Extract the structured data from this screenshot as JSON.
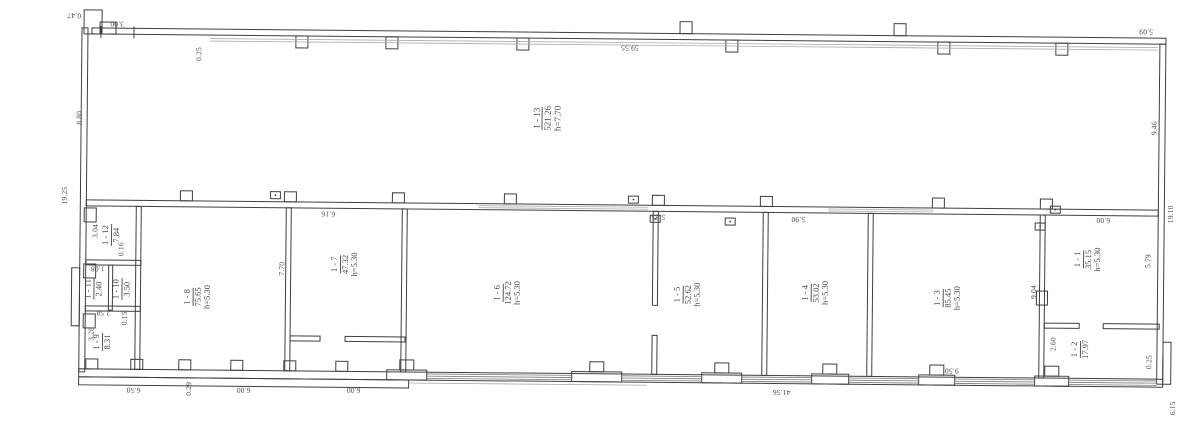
{
  "sheet": {
    "type": "scanned floor plan"
  },
  "colors": {
    "ink": "#3f3f3f",
    "paper": "#ffffff",
    "faint": "#999999"
  },
  "rooms": {
    "r1": {
      "number": "1 - 1",
      "area": "35.15",
      "height": "h=5.30"
    },
    "r2": {
      "number": "1 - 2",
      "area": "17.97"
    },
    "r3": {
      "number": "1 - 3",
      "area": "85.45",
      "height": "h=5.30"
    },
    "r4": {
      "number": "1 - 4",
      "area": "53.02",
      "height": "h=5.30"
    },
    "r5": {
      "number": "1 - 5",
      "area": "52.62",
      "height": "h=5.30"
    },
    "r6": {
      "number": "1 - 6",
      "area": "124.72",
      "height": "h=5.30"
    },
    "r7": {
      "number": "1 - 7",
      "area": "47.32",
      "height": "h=5.30"
    },
    "r8": {
      "number": "1 - 8",
      "area": "75.65",
      "height": "h=5.30"
    },
    "r9": {
      "number": "1 - 9",
      "area": "8.31"
    },
    "r10": {
      "number": "1 - 10",
      "area": "3.50"
    },
    "r11": {
      "number": "1 - 11",
      "area": "2.40"
    },
    "r12": {
      "number": "1 - 12",
      "area": "7.84"
    },
    "r13": {
      "number": "1 - 13",
      "area": "521.26",
      "height": "h=7.70"
    }
  },
  "dims": {
    "d047": "0.47",
    "d300": "3.00",
    "d025a": "0.25",
    "d5955": "59.55",
    "d509": "5.09",
    "d880": "8.80",
    "d1925": "19.25",
    "d946": "9.46",
    "d1910": "19.10",
    "d600tr": "6.00",
    "d579": "5.79",
    "d904": "9.04",
    "d260": "2.60",
    "d025b": "0.25",
    "d616": "6.16",
    "d585": "5.85",
    "d590": "5.90",
    "d770": "7.70",
    "d650": "6.50",
    "d029": "0.29",
    "d600b1": "6.00",
    "d600b2": "6.00",
    "d4156": "41.56",
    "d950": "9.50",
    "d615": "6.15",
    "d304": "3.04",
    "d016": "0.16",
    "d108": "1.08",
    "d258": "2.58",
    "d015": "0.15",
    "d328": "3.28"
  }
}
